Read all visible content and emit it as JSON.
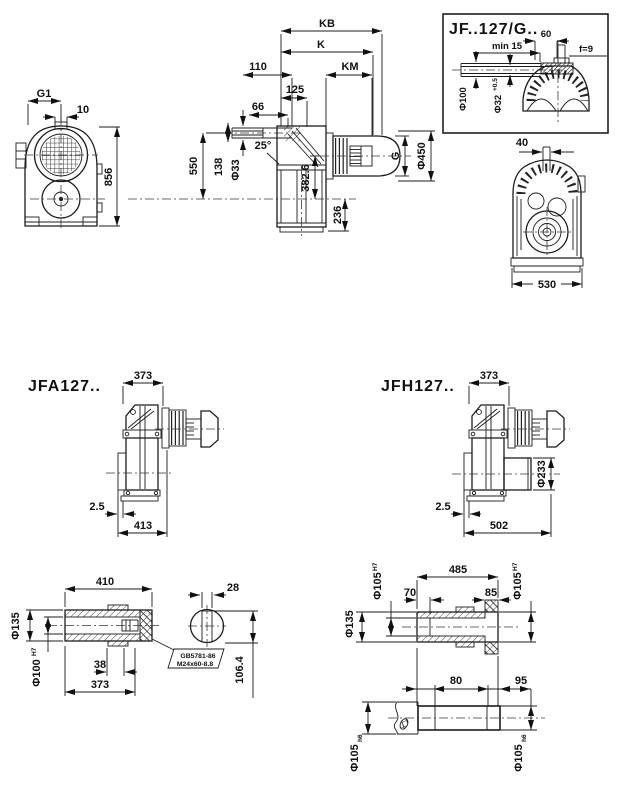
{
  "front_view": {
    "g1": "G1",
    "width_10": "10",
    "height_856": "856"
  },
  "side_view": {
    "kb": "KB",
    "k": "K",
    "km": "KM",
    "w110": "110",
    "w125": "125",
    "w66": "66",
    "h550": "550",
    "h138": "138",
    "dia33": "Φ33",
    "angle": "25°",
    "h382": "382.6",
    "h236": "236",
    "g": "G",
    "dia450": "Φ450"
  },
  "inset": {
    "title": "JF..127/G..",
    "w60": "60",
    "min15": "min 15",
    "f9": "f=9",
    "dia100": "Φ100",
    "dia32": "Φ32",
    "dia32_tol": "+0.5"
  },
  "rear_view": {
    "w40": "40",
    "w530": "530"
  },
  "jfa_view": {
    "title": "JFA127..",
    "w373": "373",
    "off": "2.5",
    "w413": "413"
  },
  "jfh_view": {
    "title": "JFH127..",
    "w373": "373",
    "dia233": "Φ233",
    "off": "2.5",
    "w502": "502"
  },
  "hollow_shaft": {
    "l410": "410",
    "dia135": "Φ135",
    "dia100": "Φ100",
    "dia100_tol": "H7",
    "l38": "38",
    "l373": "373",
    "w28": "28",
    "h106": "106.4",
    "callout_line1": "GB5781-86",
    "callout_line2": "M24x60-8.8"
  },
  "plug_shaft": {
    "l485": "485",
    "l70": "70",
    "l85": "85",
    "dia135": "Φ135",
    "dia105_l": "Φ105",
    "dia105_l_tol": "H7",
    "dia105_r": "Φ105",
    "dia105_r_tol": "H7"
  },
  "solid_shaft": {
    "l80": "80",
    "l95": "95",
    "dia105_l": "Φ105",
    "dia105_l_tol": "h6",
    "dia105_r": "Φ105",
    "dia105_r_tol": "h6"
  }
}
